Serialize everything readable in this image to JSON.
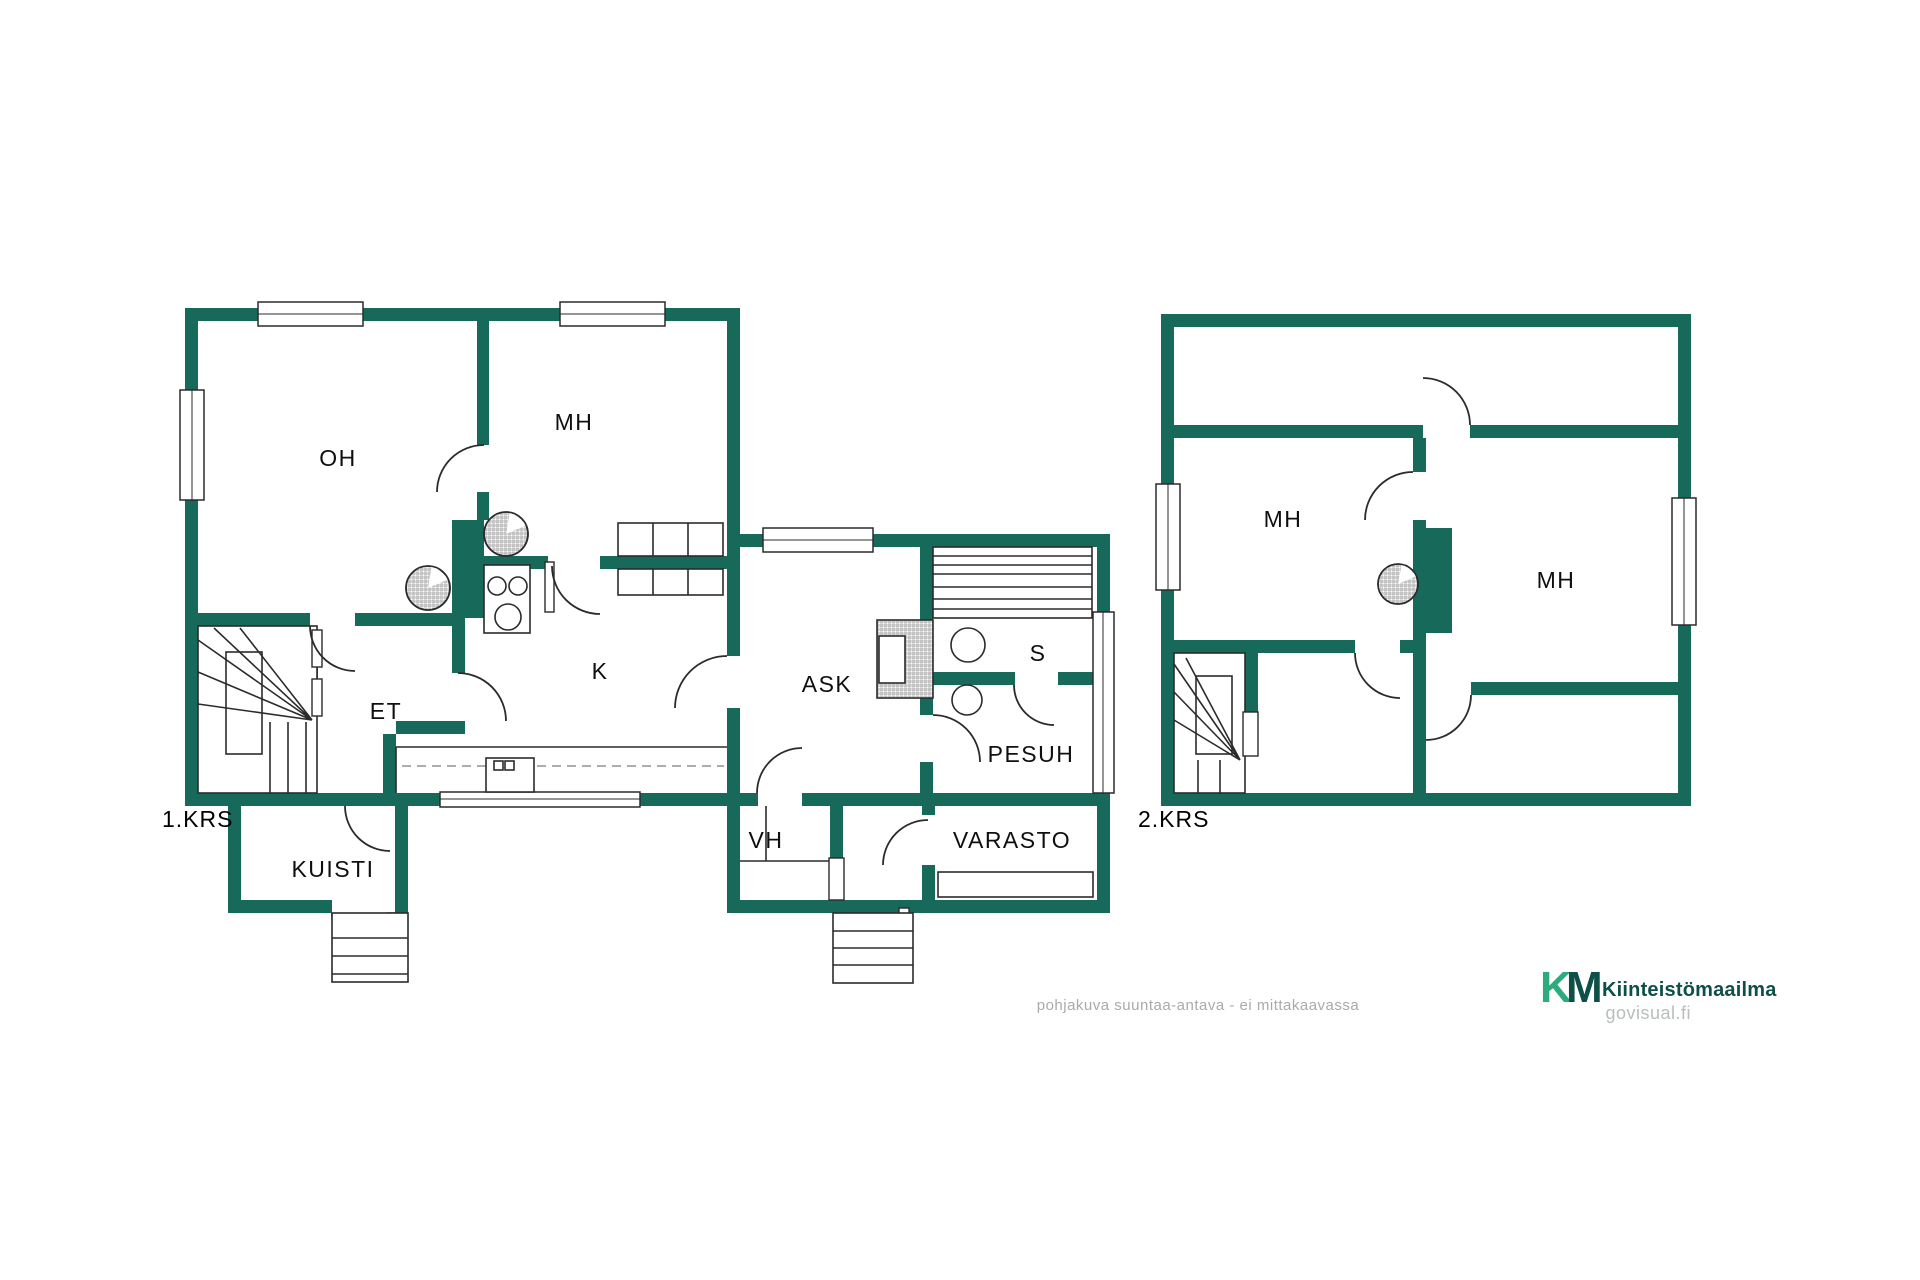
{
  "floor1": {
    "label": "1.KRS",
    "rooms": [
      {
        "label": "OH"
      },
      {
        "label": "MH"
      },
      {
        "label": "K"
      },
      {
        "label": "ET"
      },
      {
        "label": "KUISTI"
      }
    ]
  },
  "annex": {
    "rooms": [
      {
        "label": "ASK"
      },
      {
        "label": "S"
      },
      {
        "label": "PESUH"
      },
      {
        "label": "VH"
      },
      {
        "label": "VARASTO"
      }
    ]
  },
  "floor2": {
    "label": "2.KRS",
    "rooms": [
      {
        "label": "MH"
      },
      {
        "label": "MH"
      }
    ]
  },
  "footer": {
    "disclaimer": "pohjakuva suuntaa-antava - ei mittakaavassa",
    "logo_k": "K",
    "logo_m": "M",
    "brand": "Kiinteistömaailma",
    "site": "govisual.fi"
  },
  "colors": {
    "wall": "#17695A",
    "line": "#2B2B2B",
    "brand_green": "#2CAB7C",
    "brand_dark": "#0E4F47",
    "muted": "#A7ABAB",
    "muted_light": "#B9BDBD"
  }
}
